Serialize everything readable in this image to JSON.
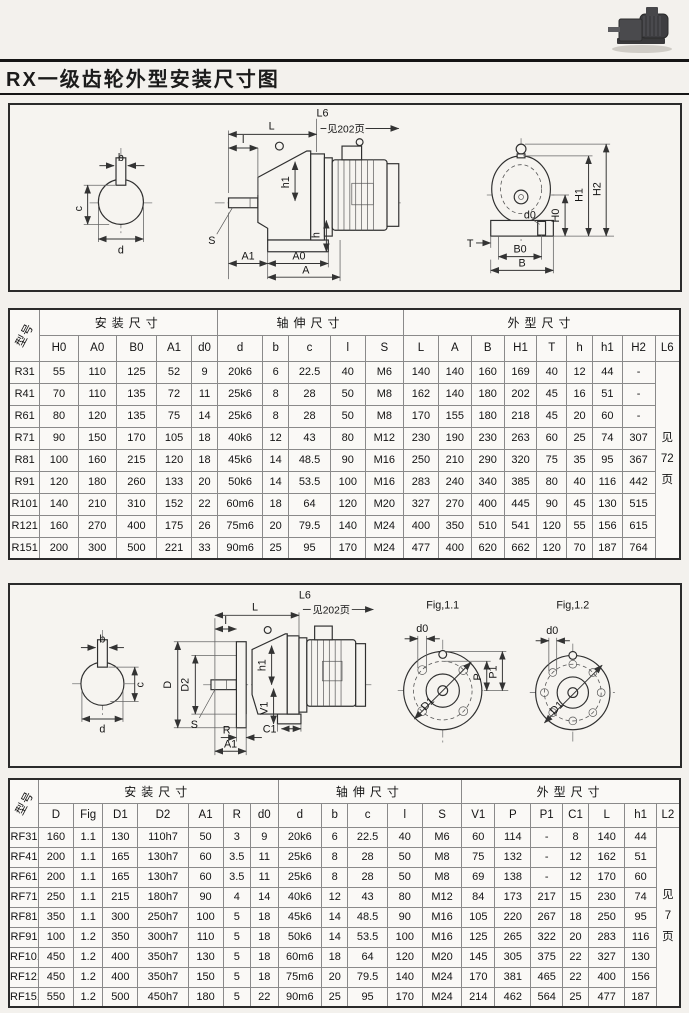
{
  "page": {
    "title": "RX一级齿轮外型安装尺寸图"
  },
  "diagram1": {
    "see_note": "见202页",
    "labels": {
      "b": "b",
      "c": "c",
      "d": "d",
      "L": "L",
      "L6": "L6",
      "l": "l",
      "S": "S",
      "h1": "h1",
      "h": "h",
      "A1": "A1",
      "A0": "A0",
      "A": "A",
      "H0": "H0",
      "H1": "H1",
      "H2": "H2",
      "T": "T",
      "d0": "d0",
      "B0": "B0",
      "B": "B"
    }
  },
  "diagram2": {
    "see_note": "见202页",
    "labels": {
      "b": "b",
      "c": "c",
      "d": "d",
      "L": "L",
      "L6": "L6",
      "l": "l",
      "S": "S",
      "h1": "h1",
      "D": "D",
      "D2": "D2",
      "V1": "V1",
      "C1": "C1",
      "R": "R",
      "A1": "A1",
      "fig11": "Fig,1.1",
      "fig12": "Fig,1.2",
      "d0": "d0",
      "P": "P",
      "P1": "P1",
      "D1": "D1"
    }
  },
  "table1": {
    "model_header": "型号",
    "groups": [
      "安装尺寸",
      "轴伸尺寸",
      "外型尺寸"
    ],
    "columns": [
      "H0",
      "A0",
      "B0",
      "A1",
      "d0",
      "d",
      "b",
      "c",
      "l",
      "S",
      "L",
      "A",
      "B",
      "H1",
      "T",
      "h",
      "h1",
      "H2",
      "L6"
    ],
    "note": [
      "见",
      "72",
      "页"
    ],
    "rows": [
      {
        "model": "R31",
        "v": [
          "55",
          "110",
          "125",
          "52",
          "9",
          "20k6",
          "6",
          "22.5",
          "40",
          "M6",
          "140",
          "140",
          "160",
          "169",
          "40",
          "12",
          "44",
          "-"
        ]
      },
      {
        "model": "R41",
        "v": [
          "70",
          "110",
          "135",
          "72",
          "11",
          "25k6",
          "8",
          "28",
          "50",
          "M8",
          "162",
          "140",
          "180",
          "202",
          "45",
          "16",
          "51",
          "-"
        ]
      },
      {
        "model": "R61",
        "v": [
          "80",
          "120",
          "135",
          "75",
          "14",
          "25k6",
          "8",
          "28",
          "50",
          "M8",
          "170",
          "155",
          "180",
          "218",
          "45",
          "20",
          "60",
          "-"
        ]
      },
      {
        "model": "R71",
        "v": [
          "90",
          "150",
          "170",
          "105",
          "18",
          "40k6",
          "12",
          "43",
          "80",
          "M12",
          "230",
          "190",
          "230",
          "263",
          "60",
          "25",
          "74",
          "307"
        ]
      },
      {
        "model": "R81",
        "v": [
          "100",
          "160",
          "215",
          "120",
          "18",
          "45k6",
          "14",
          "48.5",
          "90",
          "M16",
          "250",
          "210",
          "290",
          "320",
          "75",
          "35",
          "95",
          "367"
        ]
      },
      {
        "model": "R91",
        "v": [
          "120",
          "180",
          "260",
          "133",
          "20",
          "50k6",
          "14",
          "53.5",
          "100",
          "M16",
          "283",
          "240",
          "340",
          "385",
          "80",
          "40",
          "116",
          "442"
        ]
      },
      {
        "model": "R101",
        "v": [
          "140",
          "210",
          "310",
          "152",
          "22",
          "60m6",
          "18",
          "64",
          "120",
          "M20",
          "327",
          "270",
          "400",
          "445",
          "90",
          "45",
          "130",
          "515"
        ]
      },
      {
        "model": "R121",
        "v": [
          "160",
          "270",
          "400",
          "175",
          "26",
          "75m6",
          "20",
          "79.5",
          "140",
          "M24",
          "400",
          "350",
          "510",
          "541",
          "120",
          "55",
          "156",
          "615"
        ]
      },
      {
        "model": "R151",
        "v": [
          "200",
          "300",
          "500",
          "221",
          "33",
          "90m6",
          "25",
          "95",
          "170",
          "M24",
          "477",
          "400",
          "620",
          "662",
          "120",
          "70",
          "187",
          "764"
        ]
      }
    ]
  },
  "table2": {
    "model_header": "型号",
    "groups": [
      "安装尺寸",
      "轴伸尺寸",
      "外型尺寸"
    ],
    "columns": [
      "D",
      "Fig",
      "D1",
      "D2",
      "A1",
      "R",
      "d0",
      "d",
      "b",
      "c",
      "l",
      "S",
      "V1",
      "P",
      "P1",
      "C1",
      "L",
      "h1",
      "L2"
    ],
    "note": [
      "见",
      "7",
      "页"
    ],
    "rows": [
      {
        "model": "RF31",
        "v": [
          "160",
          "1.1",
          "130",
          "110h7",
          "50",
          "3",
          "9",
          "20k6",
          "6",
          "22.5",
          "40",
          "M6",
          "60",
          "114",
          "-",
          "8",
          "140",
          "44"
        ]
      },
      {
        "model": "RF41",
        "v": [
          "200",
          "1.1",
          "165",
          "130h7",
          "60",
          "3.5",
          "11",
          "25k6",
          "8",
          "28",
          "50",
          "M8",
          "75",
          "132",
          "-",
          "12",
          "162",
          "51"
        ]
      },
      {
        "model": "RF61",
        "v": [
          "200",
          "1.1",
          "165",
          "130h7",
          "60",
          "3.5",
          "11",
          "25k6",
          "8",
          "28",
          "50",
          "M8",
          "69",
          "138",
          "-",
          "12",
          "170",
          "60"
        ]
      },
      {
        "model": "RF71",
        "v": [
          "250",
          "1.1",
          "215",
          "180h7",
          "90",
          "4",
          "14",
          "40k6",
          "12",
          "43",
          "80",
          "M12",
          "84",
          "173",
          "217",
          "15",
          "230",
          "74"
        ]
      },
      {
        "model": "RF81",
        "v": [
          "350",
          "1.1",
          "300",
          "250h7",
          "100",
          "5",
          "18",
          "45k6",
          "14",
          "48.5",
          "90",
          "M16",
          "105",
          "220",
          "267",
          "18",
          "250",
          "95"
        ]
      },
      {
        "model": "RF91",
        "v": [
          "100",
          "1.2",
          "350",
          "300h7",
          "110",
          "5",
          "18",
          "50k6",
          "14",
          "53.5",
          "100",
          "M16",
          "125",
          "265",
          "322",
          "20",
          "283",
          "116"
        ]
      },
      {
        "model": "RF101",
        "v": [
          "450",
          "1.2",
          "400",
          "350h7",
          "130",
          "5",
          "18",
          "60m6",
          "18",
          "64",
          "120",
          "M20",
          "145",
          "305",
          "375",
          "22",
          "327",
          "130"
        ]
      },
      {
        "model": "RF121",
        "v": [
          "450",
          "1.2",
          "400",
          "350h7",
          "150",
          "5",
          "18",
          "75m6",
          "20",
          "79.5",
          "140",
          "M24",
          "170",
          "381",
          "465",
          "22",
          "400",
          "156"
        ]
      },
      {
        "model": "RF151",
        "v": [
          "550",
          "1.2",
          "500",
          "450h7",
          "180",
          "5",
          "22",
          "90m6",
          "25",
          "95",
          "170",
          "M24",
          "214",
          "462",
          "564",
          "25",
          "477",
          "187"
        ]
      }
    ]
  }
}
